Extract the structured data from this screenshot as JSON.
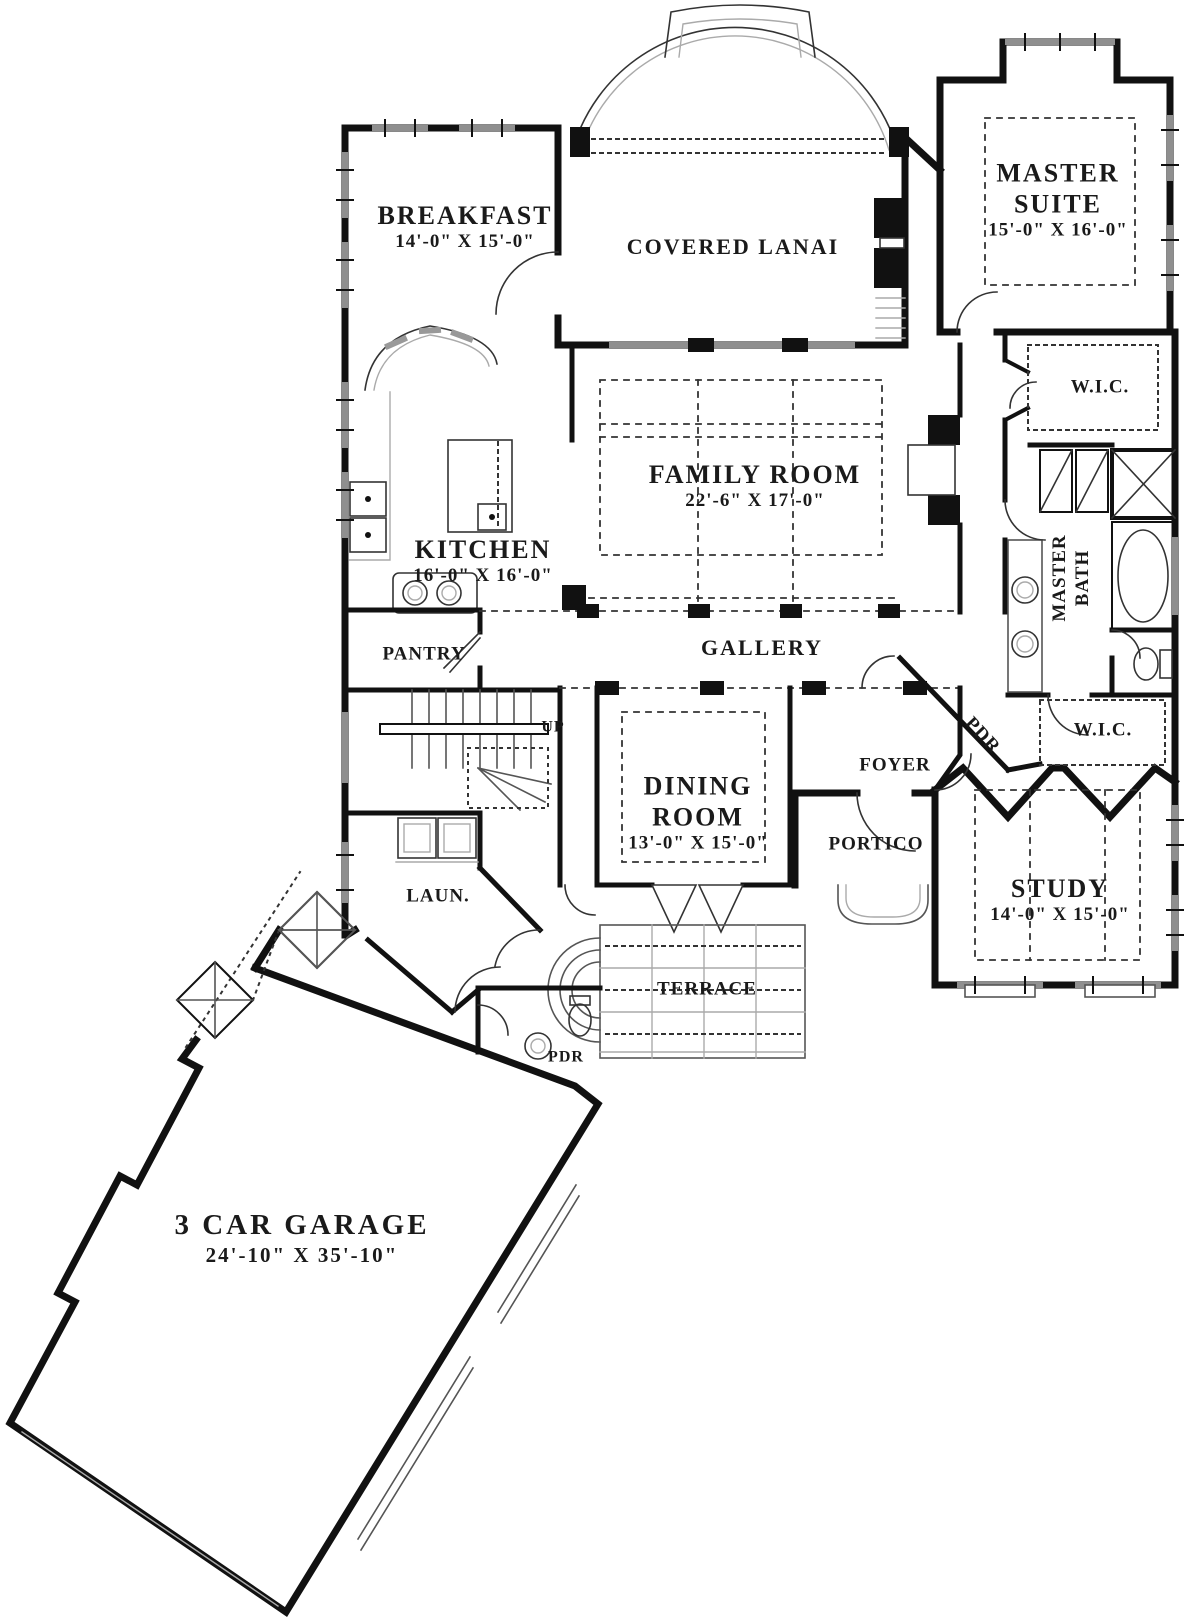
{
  "colors": {
    "wall": "#111111",
    "window": "#8f8f8f",
    "dash": "#333333",
    "text": "#1a1a1a",
    "bg": "#ffffff"
  },
  "rooms": {
    "breakfast": {
      "label": "BREAKFAST",
      "dims": "14'-0\" X 15'-0\""
    },
    "covered_lanai": {
      "label": "COVERED LANAI",
      "dims": ""
    },
    "master_suite": {
      "label": "MASTER SUITE",
      "dims": "15'-0\" X 16'-0\""
    },
    "family_room": {
      "label": "FAMILY ROOM",
      "dims": "22'-6\" X 17'-0\""
    },
    "kitchen": {
      "label": "KITCHEN",
      "dims": "16'-0\" X 16'-0\""
    },
    "wic_master": {
      "label": "W.I.C.",
      "dims": ""
    },
    "master_bath": {
      "label": "MASTER BATH",
      "dims": ""
    },
    "pantry": {
      "label": "PANTRY",
      "dims": ""
    },
    "gallery": {
      "label": "GALLERY",
      "dims": ""
    },
    "stairs": {
      "label": "UP",
      "dims": ""
    },
    "dining_room": {
      "label": "DINING ROOM",
      "dims": "13'-0\" X 15'-0\""
    },
    "foyer": {
      "label": "FOYER",
      "dims": ""
    },
    "powder_foyer": {
      "label": "PDR",
      "dims": ""
    },
    "wic_hall": {
      "label": "W.I.C.",
      "dims": ""
    },
    "study": {
      "label": "STUDY",
      "dims": "14'-0\" X 15'-0\""
    },
    "portico": {
      "label": "PORTICO",
      "dims": ""
    },
    "laundry": {
      "label": "LAUN.",
      "dims": ""
    },
    "terrace": {
      "label": "TERRACE",
      "dims": ""
    },
    "powder_garage": {
      "label": "PDR",
      "dims": ""
    },
    "garage": {
      "label": "3 CAR GARAGE",
      "dims": "24'-10\" X 35'-10\""
    }
  }
}
